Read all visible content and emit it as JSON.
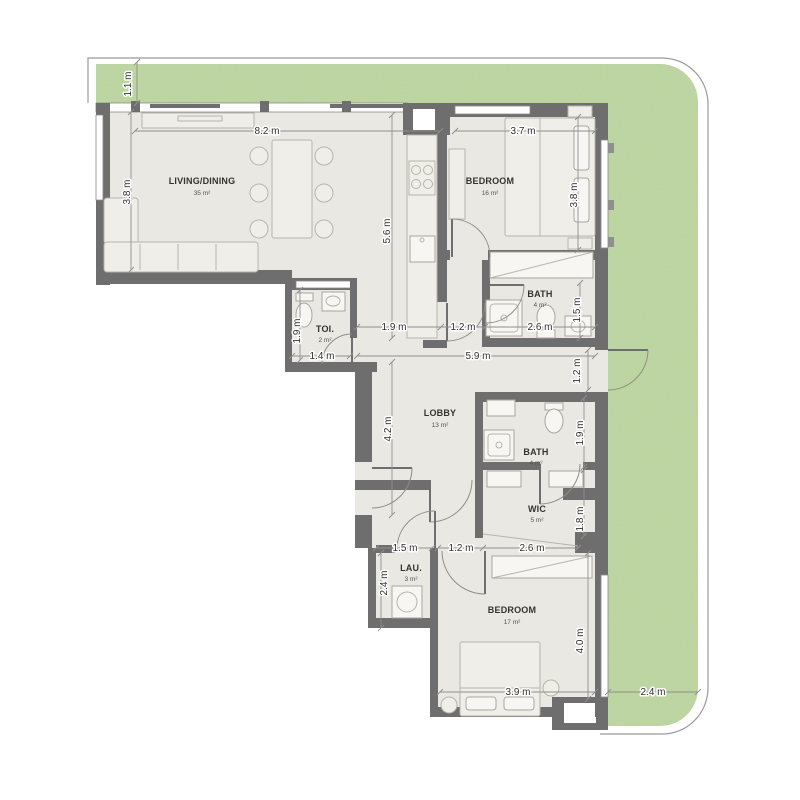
{
  "plan_title": "Apartment floor plan",
  "rooms": [
    {
      "name": "LIVING/DINING",
      "area": "35 m²"
    },
    {
      "name": "BEDROOM",
      "area": "16 m²"
    },
    {
      "name": "BATH",
      "area": "4 m²"
    },
    {
      "name": "TOI.",
      "area": "2 m²"
    },
    {
      "name": "LOBBY",
      "area": "13 m²"
    },
    {
      "name": "BATH",
      "area": "4 m²"
    },
    {
      "name": "WIC",
      "area": "5 m²"
    },
    {
      "name": "LAU.",
      "area": "3 m²"
    },
    {
      "name": "BEDROOM",
      "area": "17 m²"
    }
  ],
  "dimensions": {
    "terrace_top_height": "1.1 m",
    "living_width": "8.2 m",
    "living_height": "3.8 m",
    "kitchen_height": "5.6 m",
    "bedroom1_width": "3.7 m",
    "bedroom1_height": "3.8 m",
    "passage_width": "1.9 m",
    "corridor1_width": "1.2 m",
    "bath1_width": "2.6 m",
    "bath1_height": "1.5 m",
    "toi_height": "1.9 m",
    "toi_width": "1.4 m",
    "hall_length": "5.9 m",
    "exit_door_width": "1.2 m",
    "lobby_height": "4.2 m",
    "bath2_height": "1.9 m",
    "wic_height": "1.8 m",
    "lau_width": "1.5 m",
    "hall2_width": "1.2 m",
    "wic_width": "2.6 m",
    "lau_height": "2.4 m",
    "bedroom2_height": "4.0 m",
    "bedroom2_width": "3.9 m",
    "terrace_right_width": "2.4 m"
  },
  "colors": {
    "wall": "#6e6e6e",
    "floor": "#eae8e2",
    "terrace": "#bed7a3",
    "terrace_speckle": "#8fae6f",
    "outline": "#9b9b9b",
    "dim_line": "#8f8f8f",
    "dim_text": "#2f2f2f",
    "room_text": "#34332f"
  }
}
